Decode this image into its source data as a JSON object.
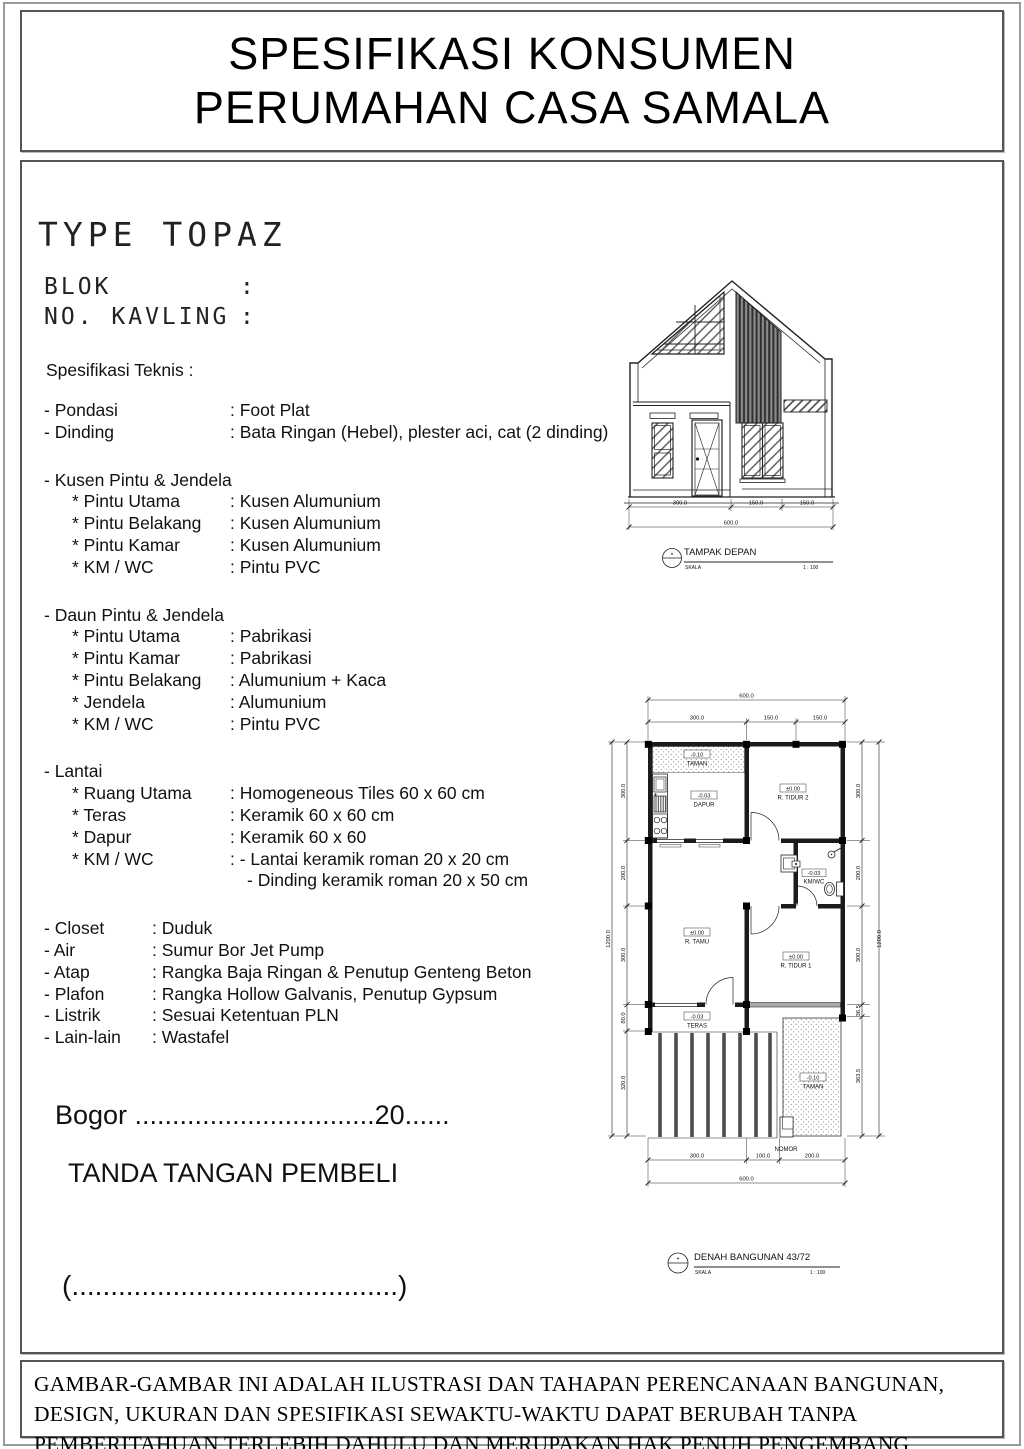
{
  "header": {
    "title_line1": "SPESIFIKASI KONSUMEN",
    "title_line2": "PERUMAHAN CASA SAMALA"
  },
  "info": {
    "type_title": "TYPE TOPAZ",
    "blok_label": "BLOK",
    "blok_colon": ":",
    "kavling_label": "NO. KAVLING",
    "kavling_colon": ":",
    "spec_heading": "Spesifikasi Teknis :"
  },
  "specs": {
    "rows": [
      {
        "t": "item",
        "label": "- Pondasi",
        "value": ": Foot Plat"
      },
      {
        "t": "item",
        "label": "- Dinding",
        "value": ": Bata Ringan (Hebel), plester aci, cat  (2 dinding)"
      },
      {
        "t": "gap"
      },
      {
        "t": "item",
        "label": "- Kusen Pintu & Jendela",
        "value": ""
      },
      {
        "t": "sub",
        "label": "* Pintu Utama",
        "value": ": Kusen Alumunium"
      },
      {
        "t": "sub",
        "label": "* Pintu Belakang",
        "value": ": Kusen Alumunium"
      },
      {
        "t": "sub",
        "label": "* Pintu Kamar",
        "value": ": Kusen Alumunium"
      },
      {
        "t": "sub",
        "label": "* KM / WC",
        "value": ": Pintu PVC"
      },
      {
        "t": "gap"
      },
      {
        "t": "item",
        "label": "- Daun Pintu & Jendela",
        "value": ""
      },
      {
        "t": "sub",
        "label": "* Pintu Utama",
        "value": ": Pabrikasi"
      },
      {
        "t": "sub",
        "label": "* Pintu Kamar",
        "value": ": Pabrikasi"
      },
      {
        "t": "sub",
        "label": "* Pintu Belakang",
        "value": ": Alumunium + Kaca"
      },
      {
        "t": "sub",
        "label": "* Jendela",
        "value": ": Alumunium"
      },
      {
        "t": "sub",
        "label": "* KM / WC",
        "value": ": Pintu PVC"
      },
      {
        "t": "gap"
      },
      {
        "t": "item",
        "label": "- Lantai",
        "value": ""
      },
      {
        "t": "sub",
        "label": "* Ruang Utama",
        "value": ": Homogeneous Tiles 60 x 60 cm"
      },
      {
        "t": "sub",
        "label": "* Teras",
        "value": ": Keramik 60 x 60 cm"
      },
      {
        "t": "sub",
        "label": "* Dapur",
        "value": ": Keramik 60 x 60"
      },
      {
        "t": "sub",
        "label": "* KM / WC",
        "value": ": - Lantai keramik roman 20 x 20 cm"
      },
      {
        "t": "cont",
        "label": "",
        "value": "- Dinding keramik roman 20 x 50 cm"
      },
      {
        "t": "gap"
      },
      {
        "t": "item2",
        "label": "- Closet",
        "value": ": Duduk"
      },
      {
        "t": "item2",
        "label": "- Air",
        "value": ": Sumur Bor Jet Pump"
      },
      {
        "t": "item2",
        "label": "- Atap",
        "value": ": Rangka Baja Ringan & Penutup Genteng Beton"
      },
      {
        "t": "item2",
        "label": "- Plafon",
        "value": ": Rangka Hollow Galvanis, Penutup Gypsum"
      },
      {
        "t": "item2",
        "label": "- Listrik",
        "value": ": Sesuai Ketentuan PLN"
      },
      {
        "t": "item2",
        "label": "- Lain-lain",
        "value": ": Wastafel"
      }
    ]
  },
  "signature": {
    "bogor_line": "Bogor ................................20......",
    "tanda_tangan": "TANDA TANGAN PEMBELI",
    "name_line": "(..........................................)"
  },
  "footer": {
    "disclaimer": "GAMBAR-GAMBAR INI ADALAH ILUSTRASI DAN TAHAPAN PERENCANAAN BANGUNAN, DESIGN, UKURAN DAN SPESIFIKASI SEWAKTU-WAKTU DAPAT BERUBAH TANPA PEMBERITAHUAN TERLEBIH DAHULU DAN MERUPAKAN HAK PENUH PENGEMBANG"
  },
  "elevation": {
    "dim_segments": [
      "300.0",
      "150.0",
      "150.0"
    ],
    "dim_total": "600.0",
    "title": "TAMPAK DEPAN",
    "scale_label": "SKALA",
    "scale_value": "1 : 100"
  },
  "plan": {
    "dim_top_segments": [
      "300.0",
      "150.0",
      "150.0"
    ],
    "dim_top_total": "600.0",
    "dim_bottom_segments": [
      "300.0",
      "100.0",
      "200.0"
    ],
    "dim_bottom_total": "600.0",
    "dim_left_segments": [
      "300.0",
      "200.0",
      "300.0",
      "80.0",
      "320.0"
    ],
    "dim_left_total": "1200.0",
    "dim_right_segments": [
      "300.0",
      "200.0",
      "300.0",
      "36.5",
      "363.5"
    ],
    "dim_right_total": "1200.0",
    "labels": {
      "taman_top_value": "-0.10",
      "taman_top_name": "TAMAN",
      "dapur_value": "-0.03",
      "dapur_name": "DAPUR",
      "tidur2_value": "±0.00",
      "tidur2_name": "R. TIDUR 2",
      "kmwc_value": "-0.03",
      "kmwc_name": "KM/WC",
      "tamu_value": "±0.00",
      "tamu_name": "R. TAMU",
      "tidur1_value": "±0.00",
      "tidur1_name": "R. TIDUR 1",
      "teras_value": "-0.03",
      "teras_name": "TERAS",
      "taman_bottom_value": "-0.10",
      "taman_bottom_name": "TAMAN",
      "nomor": "NOMOR"
    },
    "title": "DENAH BANGUNAN 43/72",
    "scale_label": "SKALA",
    "scale_value": "1 : 100"
  }
}
